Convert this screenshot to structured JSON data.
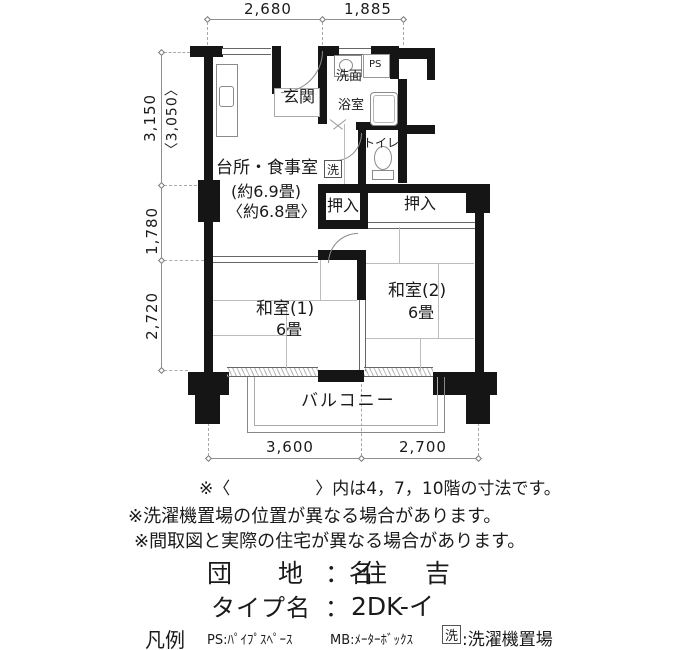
{
  "dimensions": {
    "top": [
      "2,680",
      "1,885"
    ],
    "left": [
      "3,150",
      "〈3,050〉",
      "1,780",
      "2,720"
    ],
    "bottom": [
      "3,600",
      "2,700"
    ]
  },
  "rooms": {
    "genkan": "玄関",
    "senmen": "洗面",
    "yokushitsu": "浴室",
    "ps": "PS",
    "toilet": "トイレ",
    "laundry": "洗",
    "dk": "台所・食事室",
    "dk_size": "(約6.9畳)",
    "dk_size_alt": "〈約6.8畳〉",
    "oshiire_left": "押入",
    "oshiire_right": "押入",
    "washitsu1": "和室(1)",
    "washitsu1_size": "6畳",
    "washitsu2": "和室(2)",
    "washitsu2_size": "6畳",
    "balcony": "バルコニー"
  },
  "notes": [
    "※〈　　　　　〉内は4，7，10階の寸法です。",
    "※洗濯機置場の位置が異なる場合があります。",
    "※間取図と実際の住宅が異なる場合があります。"
  ],
  "titles": {
    "estate_label": "団 地 名",
    "estate_sep": "：",
    "estate_value": "住 吉",
    "type_label": "タイプ名",
    "type_sep": "：",
    "type_value": "2DK-イ"
  },
  "legend": {
    "heading": "凡例",
    "ps_key": "PS:",
    "ps_value": "ﾊﾟｲﾌﾟｽﾍﾟｰｽ",
    "mb_key": "MB:",
    "mb_value": "ﾒｰﾀｰﾎﾞｯｸｽ",
    "laundry_key": "洗",
    "laundry_sep": ":",
    "laundry_value": "洗濯機置場"
  }
}
